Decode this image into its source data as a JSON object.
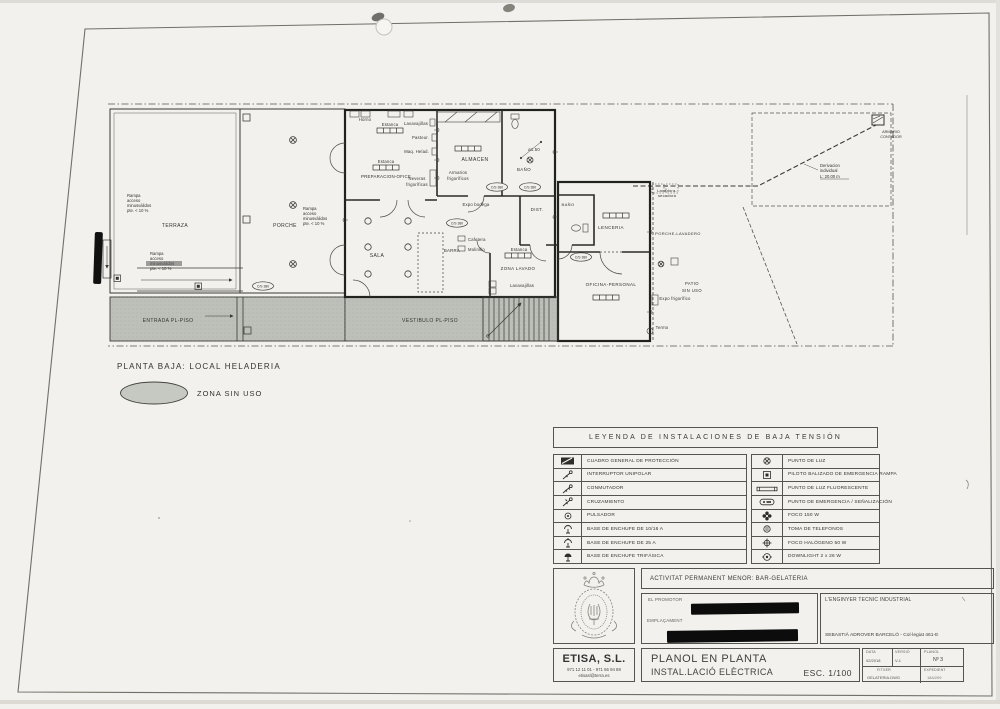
{
  "colors": {
    "ink": "#2e2d2a",
    "paper": "#f2f1ed",
    "zone_gray": "#bdc0b8",
    "redaction": "#0c0c0c"
  },
  "plan": {
    "heading": "PLANTA BAJA: LOCAL HELADERIA",
    "zone_legend": "ZONA SIN USO",
    "rooms": {
      "terraza": "TERRAZA",
      "porche": "PORCHE",
      "entrada": "ENTRADA PL-PISO",
      "vestibulo": "VESTIBULO PL-PISO",
      "sala": "SALA",
      "almacen": "ALMACEN",
      "bano": "BAÑO",
      "dist": "DIST.",
      "lenceria": "LENCERIA",
      "oficina": "OFICINA-PERSONAL",
      "porche_lavadero": "PORCHE-LAVADERO",
      "patio": [
        "PATIO",
        "SIN USO"
      ],
      "zona_lavado": "ZONA LAVADO"
    },
    "equipment": {
      "horno": "Horno",
      "estanca": "Estanca",
      "lavavajillas": "Lavavajillas",
      "pasteur": "Pasteur.",
      "maq_helad": "Maq. Helad.",
      "preparacion": "PREPARACION-OFICE",
      "neveras": [
        "Neveras",
        "frigoríficas"
      ],
      "armarios": [
        "Armarios",
        "frigoríficos"
      ],
      "expo_bodega": "Expo bodega",
      "barra": "BARRA",
      "cafetera": "Cafetera",
      "molinillo": "Molinillo",
      "lavadora": [
        "Lavadora-",
        "secadora"
      ],
      "expo_frigo": "Expo frigorífico",
      "termo": "Termo",
      "diameter": "ø1.50"
    },
    "notes": {
      "rampa": [
        "Rampa",
        "acceso",
        "minusválidos",
        "pte. < 10 %"
      ],
      "derivacion": [
        "Derivacion",
        "individual",
        "L: 20.00 m"
      ],
      "armario_contador": [
        "ARMARIO",
        "CONTADOR"
      ],
      "circuit": "C/S 380"
    }
  },
  "legend": {
    "title": "LEYENDA DE INSTALACIONES DE BAJA TENSIÓN",
    "left": [
      {
        "icon": "cuadro-general-icon",
        "label": "CUADRO GENERAL DE PROTECCIÓN"
      },
      {
        "icon": "interruptor-unipolar-icon",
        "label": "INTERRUPTOR UNIPOLAR"
      },
      {
        "icon": "conmutador-icon",
        "label": "CONMUTADOR"
      },
      {
        "icon": "cruzamiento-icon",
        "label": "CRUZAMIENTO"
      },
      {
        "icon": "pulsador-icon",
        "label": "PULSADOR"
      },
      {
        "icon": "enchufe-1016-icon",
        "label": "BASE DE ENCHUFE DE 10/16 A"
      },
      {
        "icon": "enchufe-25-icon",
        "label": "BASE DE ENCHUFE DE 25 A"
      },
      {
        "icon": "enchufe-trifasica-icon",
        "label": "BASE DE ENCHUFE TRIFÁSICA"
      }
    ],
    "right": [
      {
        "icon": "punto-de-luz-icon",
        "label": "PUNTO DE LUZ"
      },
      {
        "icon": "piloto-emergencia-icon",
        "label": "PILOTO BALIZADO DE EMERGENCIA RAMPA"
      },
      {
        "icon": "fluorescente-icon",
        "label": "PUNTO DE LUZ FLUORESCENTE"
      },
      {
        "icon": "emergencia-senalizacion-icon",
        "label": "PUNTO DE EMERGENCIA / SEÑALIZACIÓN"
      },
      {
        "icon": "foco-150-icon",
        "label": "FOCO 150 W"
      },
      {
        "icon": "toma-telefonos-icon",
        "label": "TOMA DE TELEFONOS"
      },
      {
        "icon": "foco-halogeno-icon",
        "label": "FOCO HALÓGENO 50 W"
      },
      {
        "icon": "downlight-icon",
        "label": "DOWNLIGHT 2 x 26 W"
      }
    ]
  },
  "title_block": {
    "activity": "ACTIVITAT PERMANENT MENOR: BAR-GELATERIA",
    "promotor_label": "EL PROMOTOR",
    "emplacament_label": "EMPLAÇAMENT",
    "engineer_label": "L'ENGINYER TECNIC INDUSTRIAL",
    "engineer_name": "SEBASTIÀ ADROVER BARCELÓ - Col·legiat 461-E",
    "company": "ETISA, S.L.",
    "phone": "971 12 11 01 - 971 66 94 88",
    "email": "etisasl@terra.es",
    "doc_title1": "PLANOL EN PLANTA",
    "doc_title2": "INSTAL.LACIÓ ELÈCTRICA",
    "scale": "ESC. 1/100",
    "fields": {
      "data_label": "DATA",
      "data_value": "02/2018",
      "versio_label": "VERSIÓ",
      "versio_value": "V-1",
      "planol_label": "PLANOL",
      "planol_value": "Nº 3",
      "fitxer_label": "FITXER",
      "fitxer_value": "GELATERIA.DWG",
      "expedient_label": "EXPEDIENT",
      "expedient_value": "184/209"
    }
  }
}
